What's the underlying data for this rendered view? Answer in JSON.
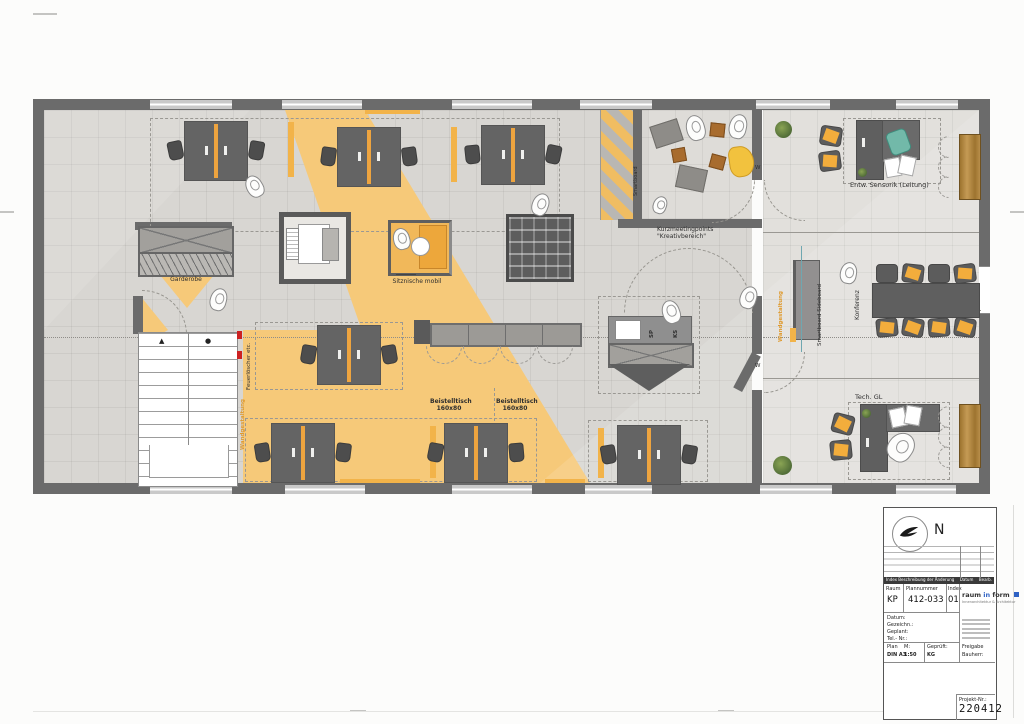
{
  "plan": {
    "labels": {
      "garderobe": "Garderobe",
      "sitznische": "Sitznische mobil",
      "beistelltisch": "Beistelltisch",
      "beistelltisch_size": "160x80",
      "kurzmeeting1": "Kurzmeetingpoints",
      "kurzmeeting2": "\"Kreativbereich\"",
      "entw_sensorik": "Entw. Sensorik (Leitung)",
      "tech_gl": "Tech. GL",
      "konferenz": "Konferenz",
      "smartboard": "Smartboard",
      "smartboard_sideboard": "Smartboard Sideboard",
      "wandgestaltung": "Wandgestaltung",
      "feuerloescher": "Feuerlöscher etc.",
      "sp": "SP",
      "ks": "KS",
      "door_w": "W"
    },
    "colors": {
      "carpet_yellow": "#f6c979",
      "accent_orange": "#eea43f",
      "wall_gray": "#6b6b6b",
      "alert_red": "#cc2222"
    }
  },
  "titleblock": {
    "north": "N",
    "rev_header_left": "Index  Beschreibung der Änderung",
    "rev_header_datum": "Datum",
    "rev_header_bearb": "Bearb.",
    "col_raum": "Raum",
    "col_plannummer": "Plannummer",
    "col_index": "Index",
    "raum": "KP",
    "plannummer": "412-033",
    "index": "01",
    "logo_raum": "raum",
    "logo_in": "in",
    "logo_form": "form",
    "logo_sub": "Innenarchitektur & Architektur",
    "datum_label": "Datum:",
    "gezeichnet_label": "Gezeichn.:",
    "geplant_label": "Geplant:",
    "tel_label": "Tel.- Nr.:",
    "plan_label": "Plan",
    "plan_value": "DIN A3",
    "m_label": "M:",
    "m_value": "1:50",
    "geprueft_label": "Geprüft:",
    "geprueft_value": "KG",
    "freigabe_label": "Freigabe Bauherr:",
    "projekt_label": "Projekt-Nr.:",
    "projekt_nr": "220412"
  }
}
